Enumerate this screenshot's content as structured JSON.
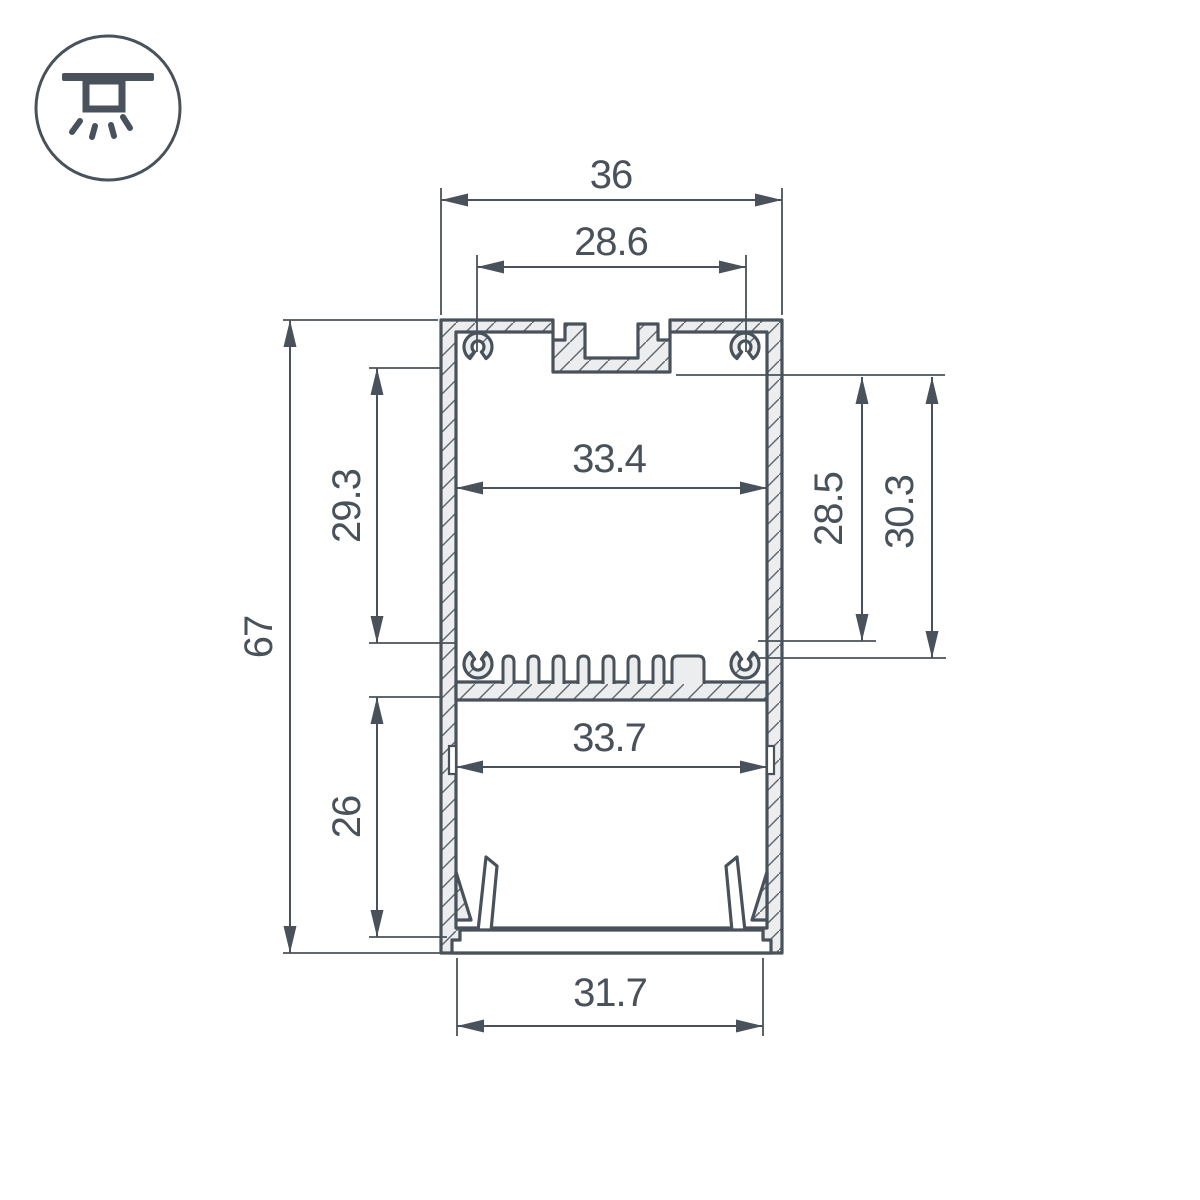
{
  "icon": {
    "name": "ceiling-light-icon"
  },
  "dimensions": {
    "overall_width": "36",
    "mount_groove_width": "28.6",
    "upper_chamber_height": "29.3",
    "overall_height": "67",
    "upper_chamber_width": "33.4",
    "depth_to_shelf": "28.5",
    "depth_to_fins": "30.3",
    "lower_chamber_height": "26",
    "lower_chamber_width": "33.7",
    "diffuser_width": "31.7"
  },
  "colors": {
    "line": "#49525a",
    "material_fill": "#ebedee",
    "background": "#ffffff"
  }
}
